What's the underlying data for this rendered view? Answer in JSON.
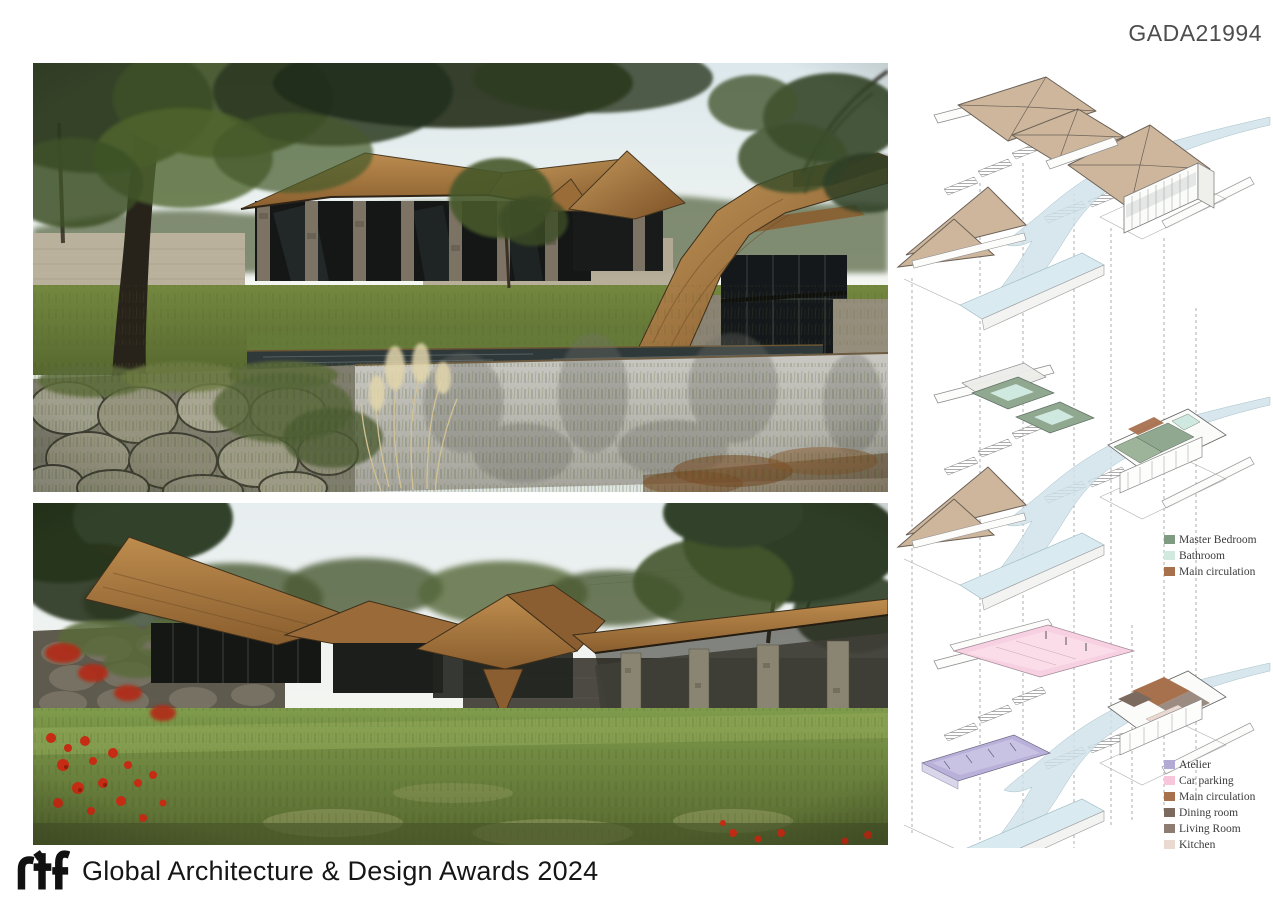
{
  "board": {
    "id": "GADA21994"
  },
  "footer": {
    "logo_text": "rtf",
    "title": "Global Architecture & Design Awards 2024"
  },
  "legends": {
    "upper": {
      "items": [
        {
          "label": "Master Bedroom",
          "color": "#7f9c82"
        },
        {
          "label": "Bathroom",
          "color": "#d2e9e0"
        },
        {
          "label": "Main circulation",
          "color": "#a8714e"
        }
      ]
    },
    "lower": {
      "items": [
        {
          "label": "Atelier",
          "color": "#b2aad5"
        },
        {
          "label": "Car parking",
          "color": "#f8c6da"
        },
        {
          "label": "Main circulation",
          "color": "#a8714e"
        },
        {
          "label": "Dining room",
          "color": "#7d6a5e"
        },
        {
          "label": "Living Room",
          "color": "#8d7c72"
        },
        {
          "label": "Kitchen",
          "color": "#e9d9d1"
        }
      ]
    }
  }
}
